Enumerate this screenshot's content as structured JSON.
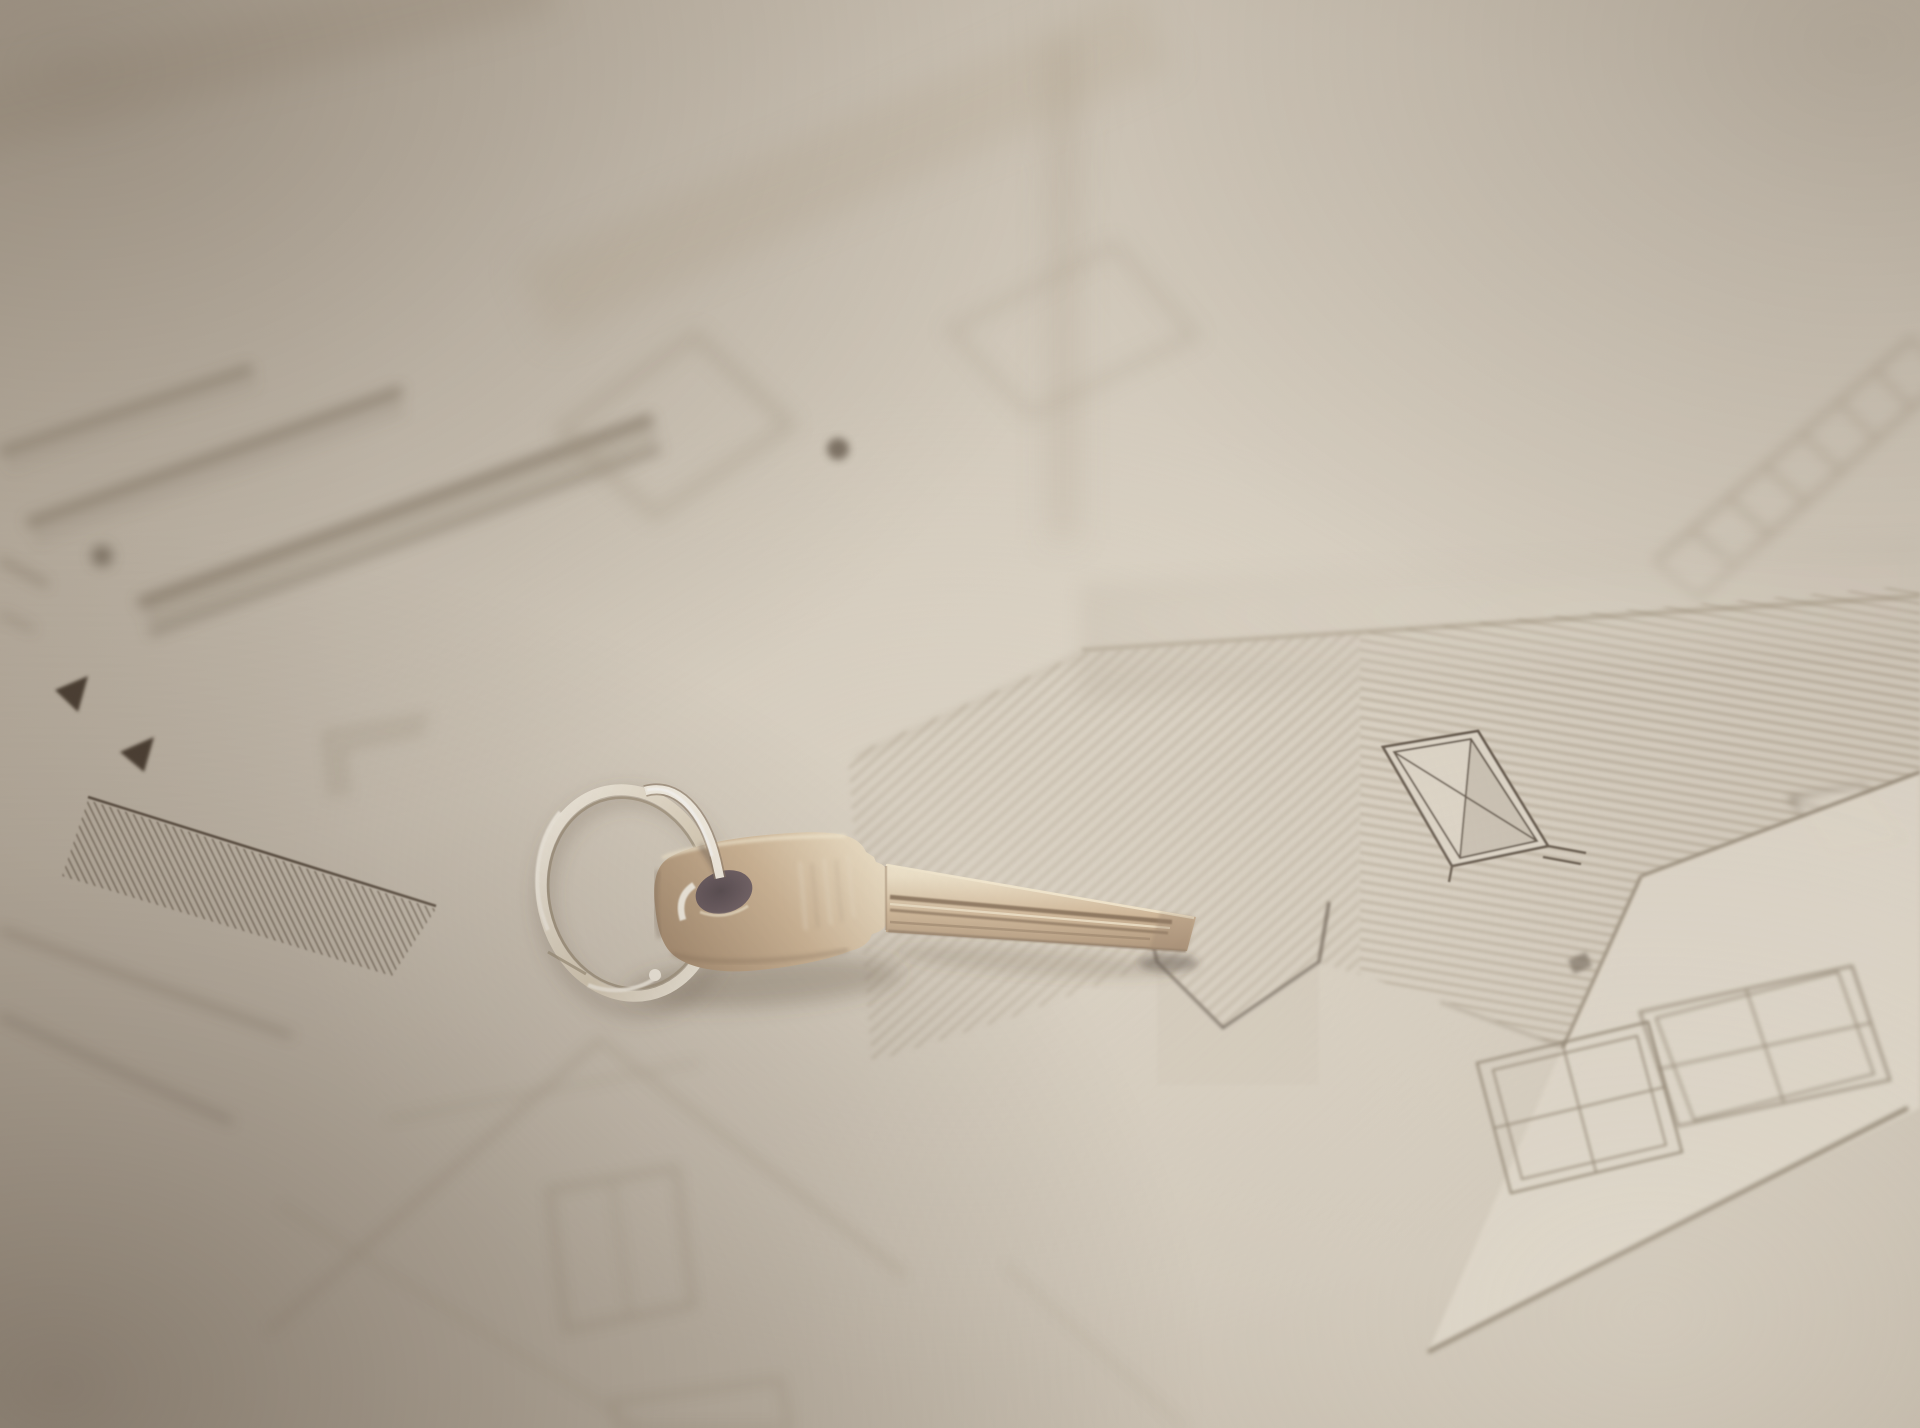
{
  "image": {
    "type": "photograph",
    "subject": "brass house key on a silver split keyring",
    "background": "architectural blueprint drawings of houses on beige paper, heavily blurred with shallow depth of field",
    "objects": [
      "brass-key",
      "split-keyring",
      "keyhole",
      "blueprint-paper",
      "hatched-roof-drawing",
      "skylight-window-drawing",
      "four-pane-window-drawings",
      "gable-house-sketch",
      "plan-bands-with-ticks",
      "dimension-arrows",
      "foundation-line"
    ]
  },
  "palette": {
    "paper_base": "#cdc4b6",
    "paper_light": "#dad2c4",
    "paper_edge": "#b3a898",
    "line_dark": "#5c5043",
    "line_mid": "#7d6f5d",
    "line_soft": "#a29581",
    "sketch_soft": "#a89b88",
    "hatch_main": "#9c8e7a",
    "hatch_dark": "#6c6052",
    "band_dark": "#7e715f",
    "arrow_dark": "#4a3e31",
    "brass_light": "#eee0c4",
    "brass_mid": "#c7aa87",
    "brass_dark": "#96785a",
    "brass_groove": "#6b4f35",
    "brass_rim": "#f4e8cd",
    "keyhole_dark": "#362a33",
    "keyhole_mid": "#594751",
    "ring_bright": "#f7f2e7",
    "ring_mid": "#d8ccb6",
    "ring_edge": "#93866f",
    "shadow_soft": "rgba(90,73,58,0.38)",
    "shadow_faint": "rgba(90,73,58,0.22)",
    "wash_light": "rgba(238,231,217,0.35)"
  }
}
